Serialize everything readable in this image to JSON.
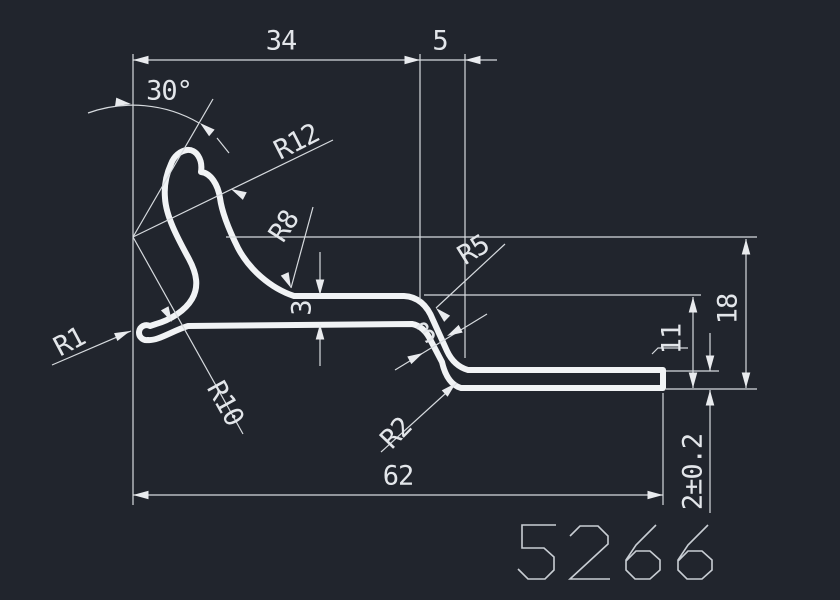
{
  "drawing": {
    "title": "profile-cross-section",
    "part_number": "5266",
    "background_color": "#21252d",
    "line_color": "#f1f3f5",
    "dim_line_color": "#d6dade",
    "text_color": "#e3e6ea"
  },
  "dimensions": {
    "top_width": "34",
    "step_width": "5",
    "angle": "30°",
    "hook_outer_radius": "R12",
    "hook_fillet_radius": "R8",
    "step_top_radius": "R5",
    "tip_radius": "R1",
    "pocket_radius": "R10",
    "step_bottom_radius": "R2",
    "mid_thickness": "3",
    "step_thickness": "3",
    "inner_height": "11",
    "total_height": "18",
    "end_thickness": "2±0.2",
    "total_length": "62"
  },
  "labels": [
    {
      "name": "dim-label-34",
      "text": "34",
      "x": 281,
      "y": 42,
      "r": 0,
      "fs": 27
    },
    {
      "name": "dim-label-5",
      "text": "5",
      "x": 440,
      "y": 42,
      "r": 0,
      "fs": 27
    },
    {
      "name": "dim-label-30deg",
      "text": "30°",
      "x": 169,
      "y": 92,
      "r": 0,
      "fs": 26
    },
    {
      "name": "dim-label-r12",
      "text": "R12",
      "x": 297,
      "y": 143,
      "r": -27,
      "fs": 26
    },
    {
      "name": "dim-label-r8",
      "text": "R8",
      "x": 285,
      "y": 227,
      "r": -57,
      "fs": 26
    },
    {
      "name": "dim-label-r5",
      "text": "R5",
      "x": 474,
      "y": 251,
      "r": -32,
      "fs": 26
    },
    {
      "name": "dim-label-r1",
      "text": "R1",
      "x": 70,
      "y": 343,
      "r": -28,
      "fs": 26
    },
    {
      "name": "dim-label-r10",
      "text": "R10",
      "x": 224,
      "y": 404,
      "r": 61,
      "fs": 26
    },
    {
      "name": "dim-label-r2",
      "text": "R2",
      "x": 397,
      "y": 434,
      "r": -46,
      "fs": 26
    },
    {
      "name": "dim-label-3-mid",
      "text": "3",
      "x": 303,
      "y": 308,
      "r": -90,
      "fs": 26
    },
    {
      "name": "dim-label-3-step",
      "text": "3",
      "x": 427,
      "y": 334,
      "r": -36,
      "fs": 26
    },
    {
      "name": "dim-label-11",
      "text": "11",
      "x": 673,
      "y": 339,
      "r": -90,
      "fs": 26
    },
    {
      "name": "dim-label-18",
      "text": "18",
      "x": 729,
      "y": 309,
      "r": -90,
      "fs": 27
    },
    {
      "name": "dim-label-2tol",
      "text": "2±0.2",
      "x": 694,
      "y": 472,
      "r": -90,
      "fs": 25
    },
    {
      "name": "dim-label-62",
      "text": "62",
      "x": 398,
      "y": 477,
      "r": 0,
      "fs": 27
    }
  ]
}
